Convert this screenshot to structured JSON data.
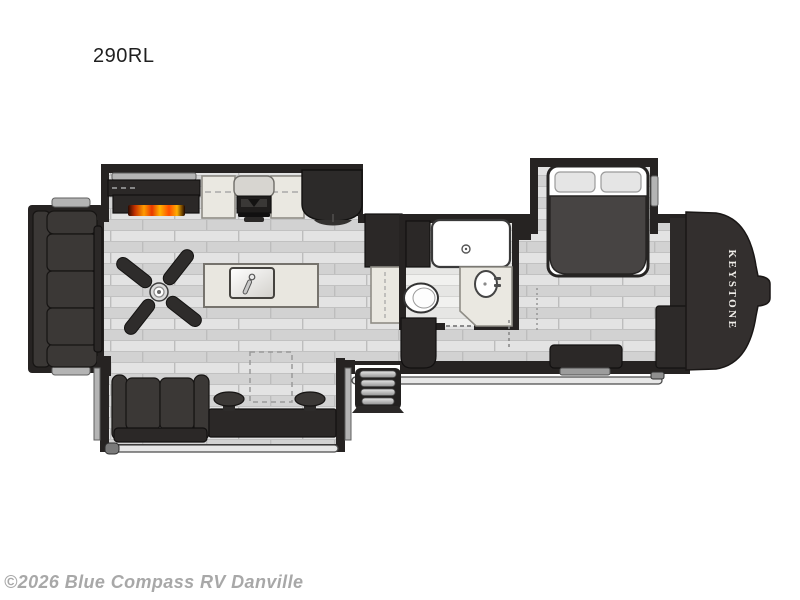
{
  "title": "290RL",
  "brand_logo_text": "KEYSTONE",
  "watermark": "©2026 Blue Compass RV Danville",
  "palette": {
    "wall": "#262322",
    "furniture": "#3b3836",
    "furniture-dark": "#2b2827",
    "counter": "#eae8e1",
    "floor-a": "#dedede",
    "floor-b": "#cfcfcf",
    "flange": "#b4b4b4",
    "flame": "#ff6a00",
    "text-dark": "#1f1f1f",
    "watermark": "#a8a8a8"
  },
  "floorplan": {
    "type": "rv-fifth-wheel-floorplan",
    "features": [
      "rear-sofa-slide",
      "theater-loveseat-slide",
      "fireplace",
      "entertainment-center",
      "kitchen-counter",
      "range-stove",
      "refrigerator",
      "pantry",
      "linen-cabinet",
      "kitchen-island-sink",
      "ceiling-fan",
      "shower",
      "toilet",
      "vanity-sink",
      "entry-door",
      "entry-steps",
      "queen-bed-slide",
      "nightstand",
      "dresser",
      "front-wardrobe",
      "awning",
      "hitch-pin"
    ]
  }
}
